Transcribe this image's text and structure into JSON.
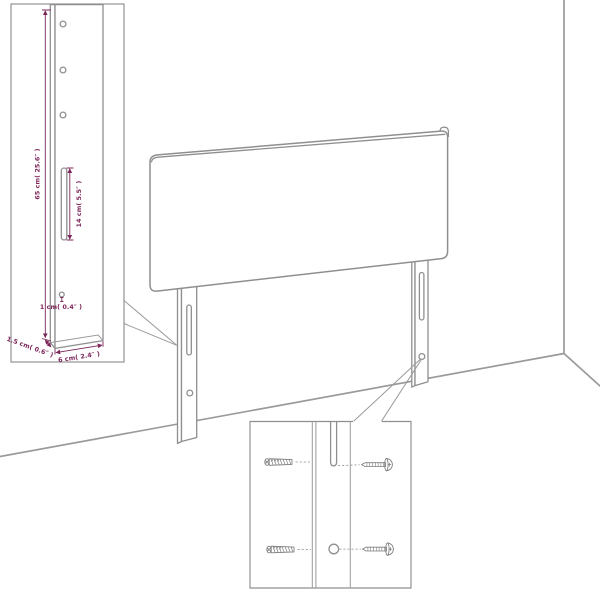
{
  "diagram_title": "headboard-assembly-dimension-diagram",
  "labels": {
    "leg_height": "65 cm( 25.6″ )",
    "slot_length": "14 cm( 5.5″ )",
    "hole_diameter": "1 cm( 0.4″ )",
    "leg_thickness": "1.5 cm( 0.6″ )",
    "leg_width": "6 cm( 2.4″ )"
  },
  "colors": {
    "drawing_line": "#8f8f8f",
    "dimension": "#7b2558",
    "background": "#ffffff"
  }
}
